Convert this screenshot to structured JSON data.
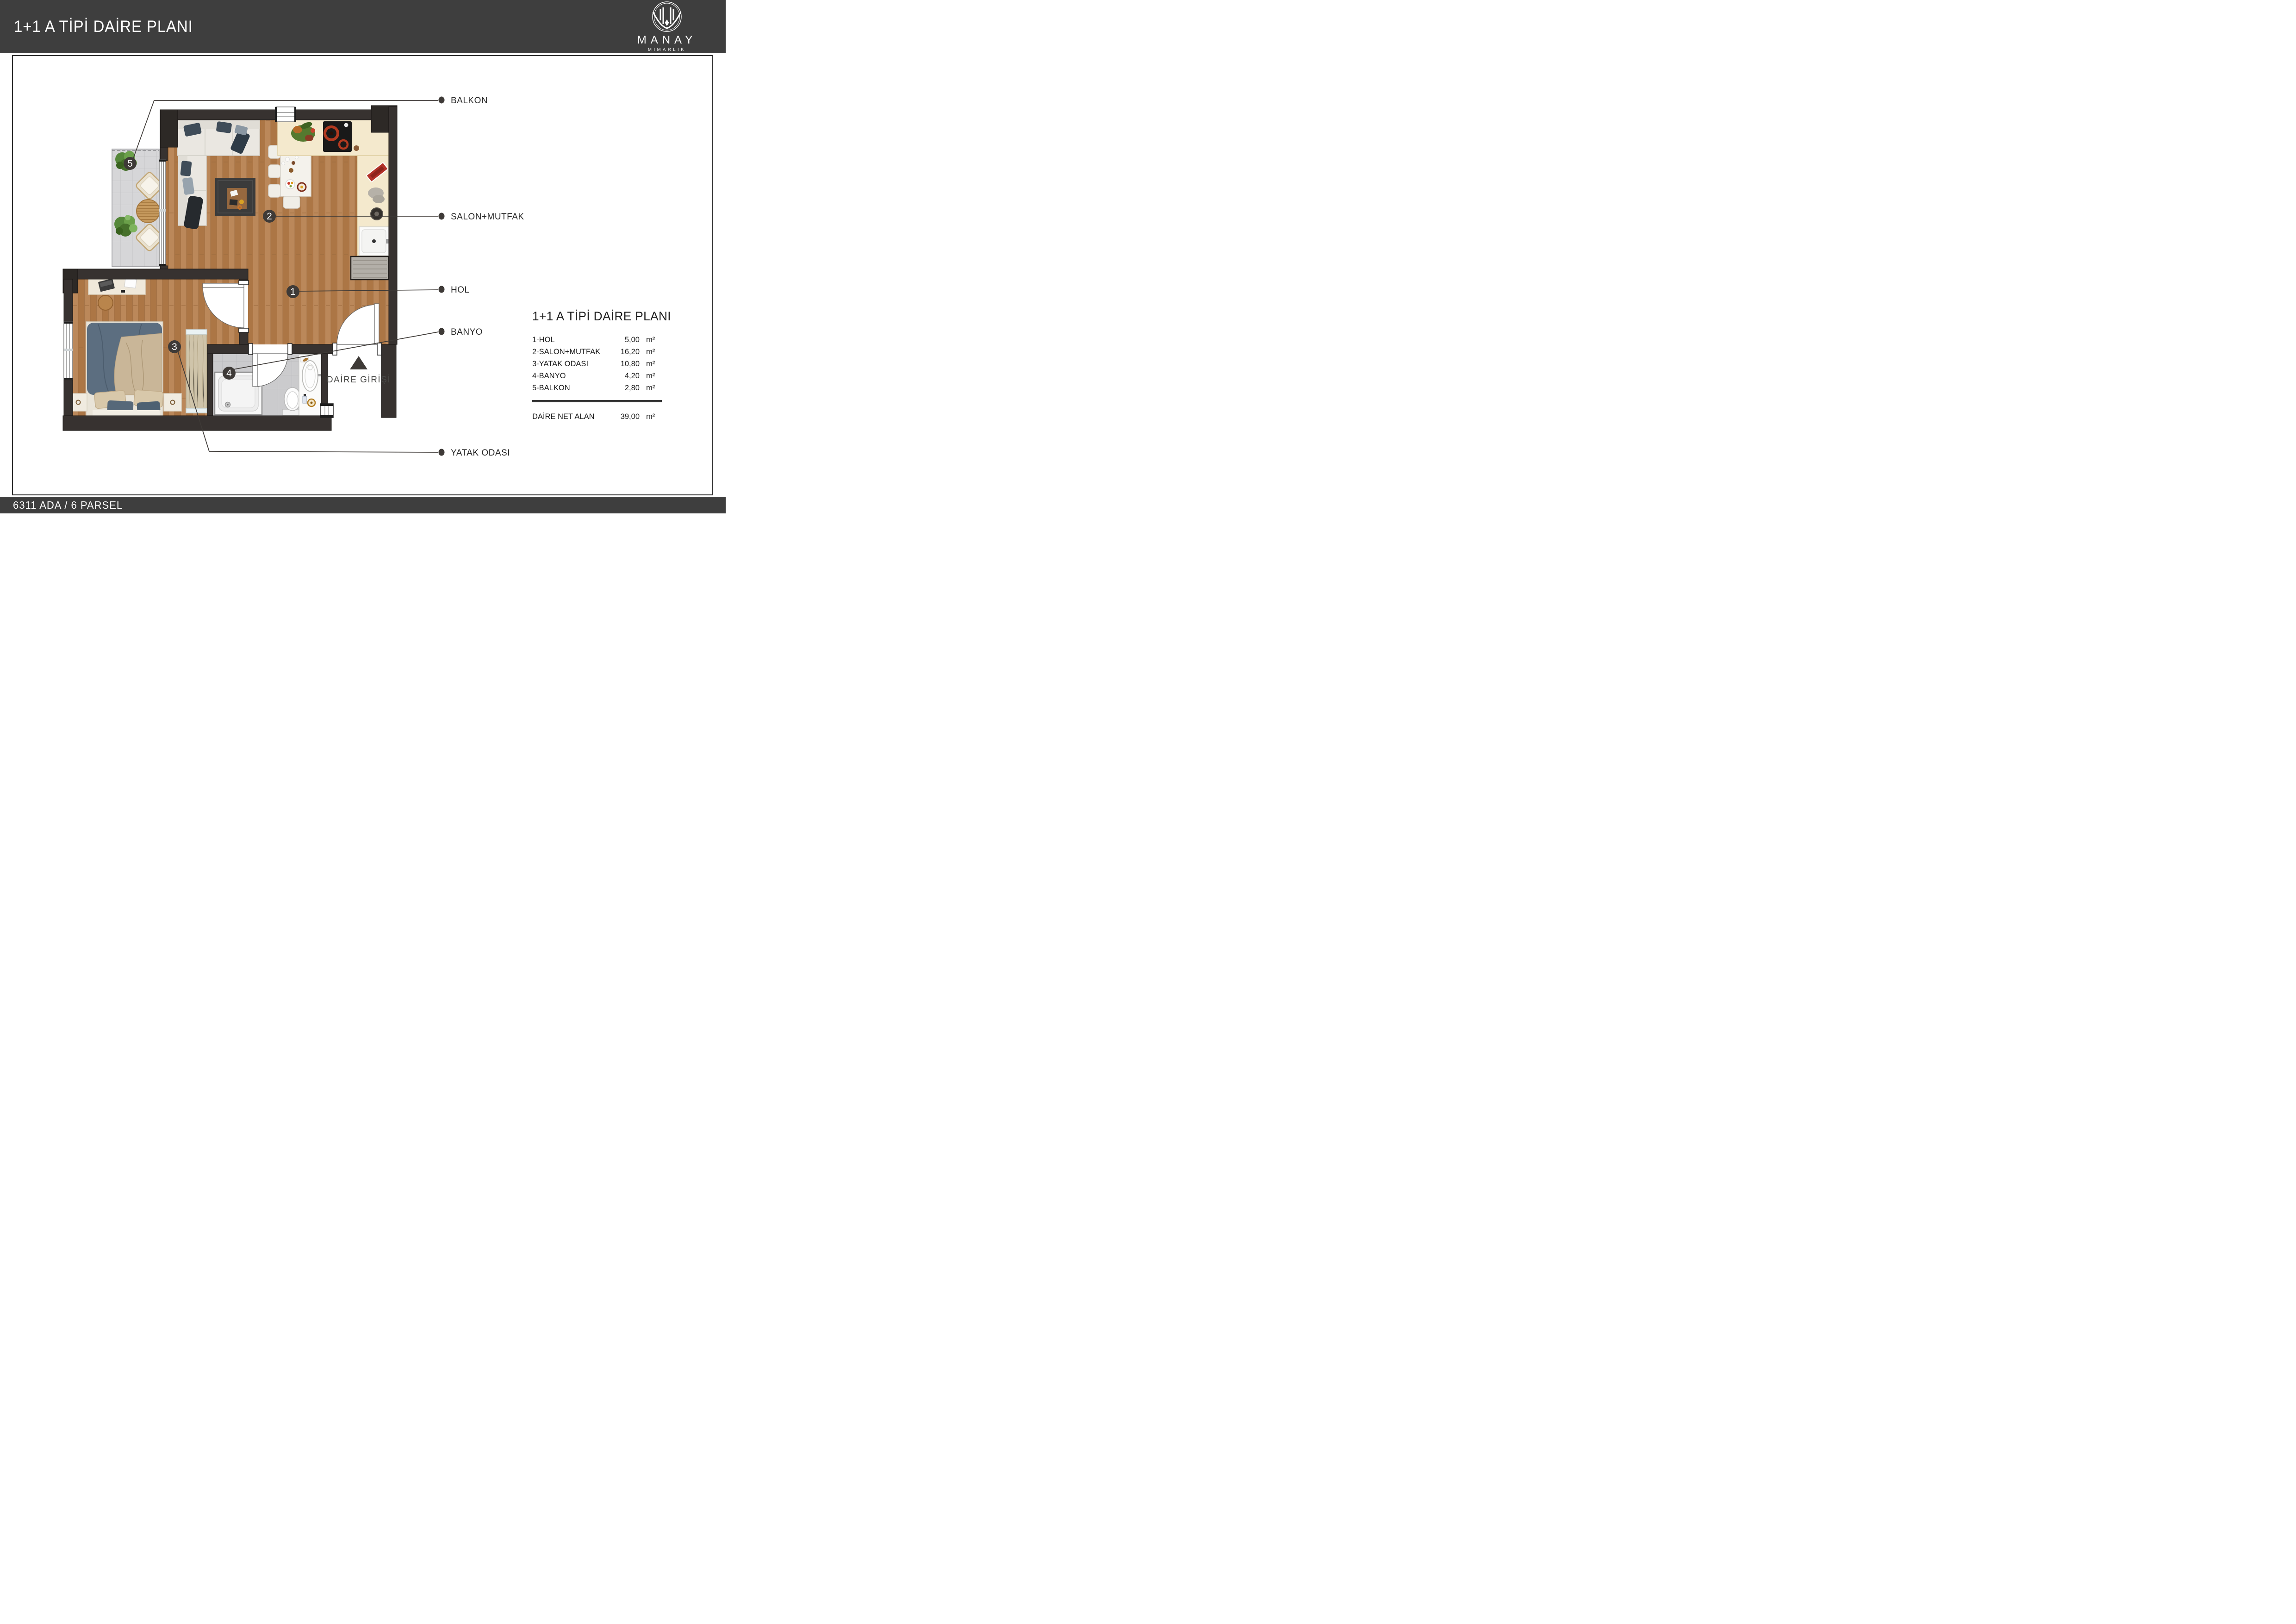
{
  "header": {
    "title": "1+1 A TİPİ DAİRE PLANI",
    "brand": {
      "name": "MANAY",
      "tagline": "MIMARLIK"
    }
  },
  "footer": {
    "text": "6311 ADA / 6 PARSEL"
  },
  "plan": {
    "entrance_label": "DAİRE GİRİŞİ",
    "callouts": [
      {
        "label": "BALKON"
      },
      {
        "label": "SALON+MUTFAK"
      },
      {
        "label": "HOL"
      },
      {
        "label": "BANYO"
      },
      {
        "label": "YATAK ODASI"
      }
    ],
    "markers": [
      {
        "number": "1",
        "room": "HOL"
      },
      {
        "number": "2",
        "room": "SALON+MUTFAK"
      },
      {
        "number": "3",
        "room": "YATAK ODASI"
      },
      {
        "number": "4",
        "room": "BANYO"
      },
      {
        "number": "5",
        "room": "BALKON"
      }
    ]
  },
  "legend": {
    "title": "1+1 A TİPİ DAİRE PLANI",
    "rows": [
      {
        "name": "1-HOL",
        "value": "5,00",
        "unit": "m²"
      },
      {
        "name": "2-SALON+MUTFAK",
        "value": "16,20",
        "unit": "m²"
      },
      {
        "name": "3-YATAK ODASI",
        "value": "10,80",
        "unit": "m²"
      },
      {
        "name": "4-BANYO",
        "value": "4,20",
        "unit": "m²"
      },
      {
        "name": "5-BALKON",
        "value": "2,80",
        "unit": "m²"
      }
    ],
    "net": {
      "label": "DAİRE NET ALAN",
      "value": "39,00",
      "unit": "m²"
    }
  },
  "colors": {
    "header_bg": "#3e3e3e",
    "wall": "#373230",
    "wood_floor": "#b5804f",
    "balcony_tile": "#d6d6d8",
    "bath_tile": "#cbcbcd",
    "kitchen_counter": "#f4e9cd",
    "marker": "#3e3a37",
    "label_text": "#262626"
  }
}
